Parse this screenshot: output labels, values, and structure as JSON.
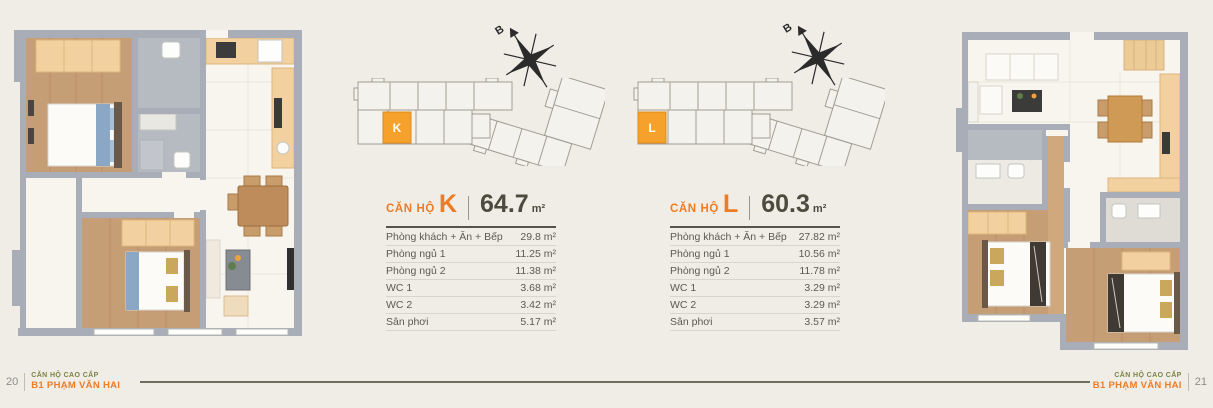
{
  "colors": {
    "background": "#efede6",
    "accent_orange": "#ee7c24",
    "marker_orange": "#f5a12b",
    "heading_dark": "#4c4b3e",
    "footer_green": "#7b8446",
    "wall_gray": "#a8adb7"
  },
  "units": [
    {
      "name": "unit-k",
      "title_prefix": "CĂN HỘ",
      "letter": "K",
      "area": "64.7",
      "area_unit": "m²",
      "compass_label": "B",
      "rows": [
        {
          "label": "Phòng khách + Ăn + Bếp",
          "value": "29.8 m²"
        },
        {
          "label": "Phòng ngủ 1",
          "value": "11.25 m²"
        },
        {
          "label": "Phòng ngủ 2",
          "value": "11.38 m²"
        },
        {
          "label": "WC 1",
          "value": "3.68 m²"
        },
        {
          "label": "WC 2",
          "value": "3.42 m²"
        },
        {
          "label": "Sân phơi",
          "value": "5.17 m²"
        }
      ]
    },
    {
      "name": "unit-l",
      "title_prefix": "CĂN HỘ",
      "letter": "L",
      "area": "60.3",
      "area_unit": "m²",
      "compass_label": "B",
      "rows": [
        {
          "label": "Phòng khách + Ăn + Bếp",
          "value": "27.82 m²"
        },
        {
          "label": "Phòng ngủ 1",
          "value": "10.56 m²"
        },
        {
          "label": "Phòng ngủ 2",
          "value": "11.78 m²"
        },
        {
          "label": "WC 1",
          "value": "3.29 m²"
        },
        {
          "label": "WC 2",
          "value": "3.29 m²"
        },
        {
          "label": "Sân phơi",
          "value": "3.57 m²"
        }
      ]
    }
  ],
  "footer": {
    "left_page": "20",
    "right_page": "21",
    "series_title": "CĂN HỘ CAO CẤP",
    "project_name": "B1 PHẠM VĂN HAI"
  }
}
